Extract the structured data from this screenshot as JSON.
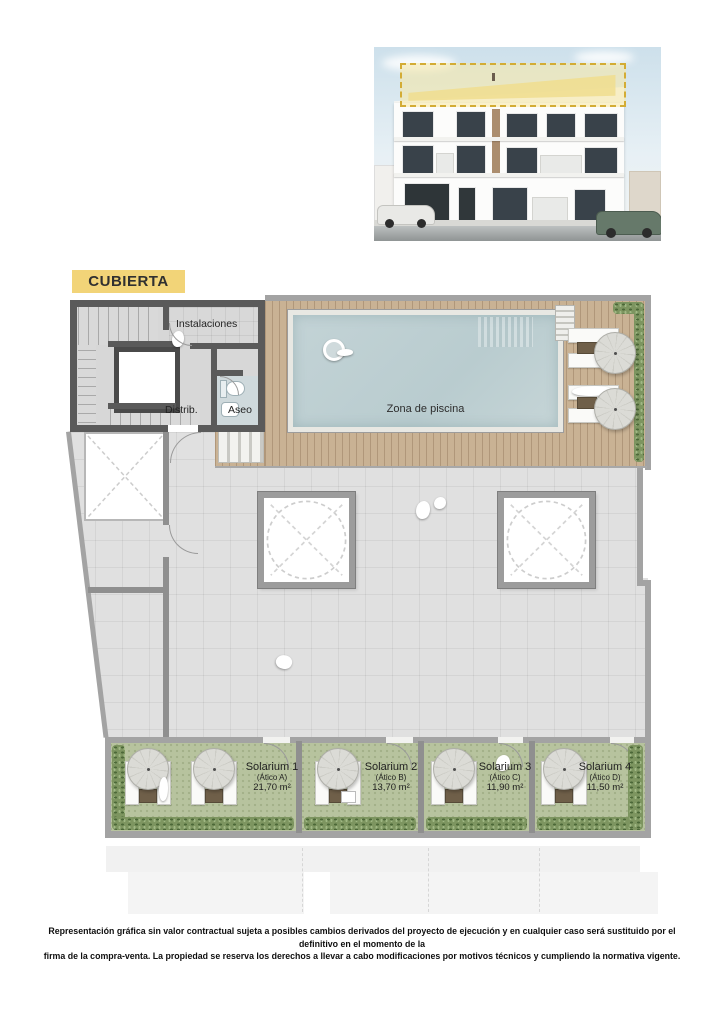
{
  "floor_badge": {
    "label": "CUBIERTA",
    "bg": "#f2d478"
  },
  "plan": {
    "labels": {
      "instalaciones": "Instalaciones",
      "distrib": "Distrib.",
      "aseo": "Aseo",
      "pool_zone": "Zona de piscina"
    },
    "solariums": [
      {
        "name": "Solarium 1",
        "unit": "(Ático A)",
        "area": "21,70 m²"
      },
      {
        "name": "Solarium 2",
        "unit": "(Ático B)",
        "area": "13,70 m²"
      },
      {
        "name": "Solarium 3",
        "unit": "(Ático C)",
        "area": "11,90 m²"
      },
      {
        "name": "Solarium 4",
        "unit": "(Ático D)",
        "area": "11,50 m²"
      }
    ],
    "colors": {
      "accent_yellow": "#f2d478",
      "pool_water": "#bfd0d3",
      "wood_deck": "#c9b294",
      "grass_green": "#b7c39e",
      "wall_dark": "#5a5a5a",
      "wall_light": "#a3a3a3"
    }
  },
  "footer": {
    "line1": "Representación gráfica sin valor contractual sujeta a posibles cambios derivados del proyecto de ejecución y en cualquier caso será sustituido por el definitivo en el momento de la",
    "line2": "firma de la compra-venta. La propiedad se reserva los derechos a llevar a cabo modificaciones por motivos técnicos y cumpliendo la normativa vigente."
  }
}
